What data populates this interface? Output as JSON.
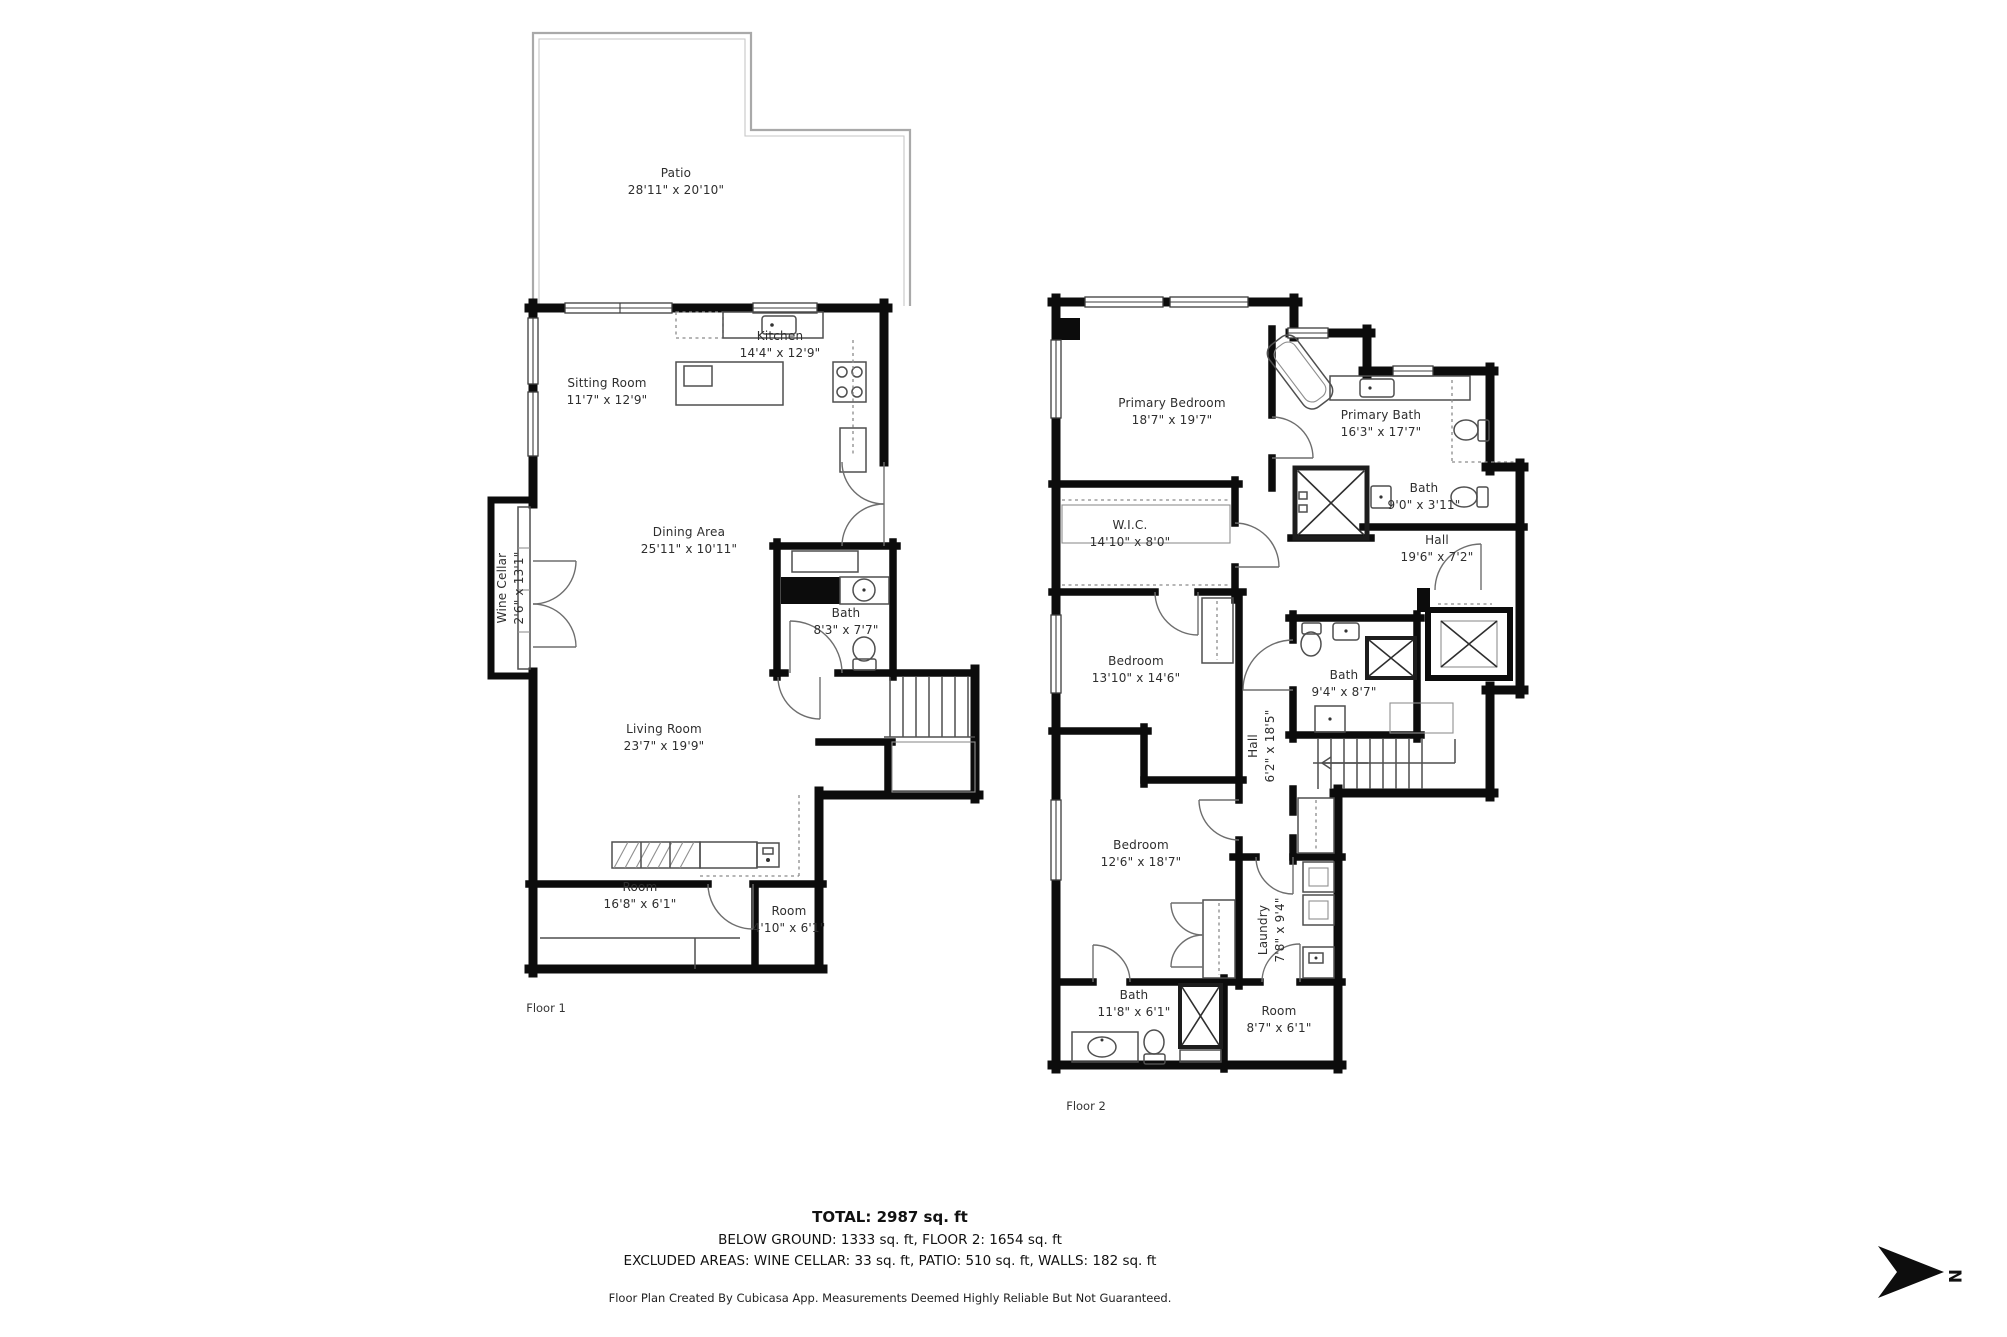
{
  "colors": {
    "wall": "#0c0c0c",
    "background": "#ffffff"
  },
  "floors": [
    {
      "caption": "Floor 1",
      "caption_pos": {
        "x": 546,
        "y": 1008
      },
      "rooms": [
        {
          "name": "Patio",
          "dims": "28'11\" x 20'10\"",
          "x": 676,
          "y": 182,
          "rotate": false
        },
        {
          "name": "Kitchen",
          "dims": "14'4\" x 12'9\"",
          "x": 780,
          "y": 345,
          "rotate": false
        },
        {
          "name": "Sitting Room",
          "dims": "11'7\" x 12'9\"",
          "x": 607,
          "y": 392,
          "rotate": false
        },
        {
          "name": "Dining Area",
          "dims": "25'11\" x 10'11\"",
          "x": 689,
          "y": 541,
          "rotate": false
        },
        {
          "name": "Wine Cellar",
          "dims": "2'6\" x 13'1\"",
          "x": 511,
          "y": 588,
          "rotate": true
        },
        {
          "name": "Bath",
          "dims": "8'3\" x 7'7\"",
          "x": 846,
          "y": 622,
          "rotate": false
        },
        {
          "name": "Living Room",
          "dims": "23'7\" x 19'9\"",
          "x": 664,
          "y": 738,
          "rotate": false
        },
        {
          "name": "Room",
          "dims": "16'8\" x 6'1\"",
          "x": 640,
          "y": 896,
          "rotate": false
        },
        {
          "name": "Room",
          "dims": "4'10\" x 6'1\"",
          "x": 789,
          "y": 920,
          "rotate": false
        }
      ]
    },
    {
      "caption": "Floor 2",
      "caption_pos": {
        "x": 1086,
        "y": 1106
      },
      "rooms": [
        {
          "name": "Primary Bedroom",
          "dims": "18'7\" x 19'7\"",
          "x": 1172,
          "y": 412,
          "rotate": false
        },
        {
          "name": "Primary Bath",
          "dims": "16'3\" x 17'7\"",
          "x": 1381,
          "y": 424,
          "rotate": false
        },
        {
          "name": "W.I.C.",
          "dims": "14'10\" x 8'0\"",
          "x": 1130,
          "y": 534,
          "rotate": false
        },
        {
          "name": "Bath",
          "dims": "9'0\" x 3'11\"",
          "x": 1424,
          "y": 497,
          "rotate": false
        },
        {
          "name": "Hall",
          "dims": "19'6\" x 7'2\"",
          "x": 1437,
          "y": 549,
          "rotate": false
        },
        {
          "name": "Bedroom",
          "dims": "13'10\" x 14'6\"",
          "x": 1136,
          "y": 670,
          "rotate": false
        },
        {
          "name": "Bath",
          "dims": "9'4\" x 8'7\"",
          "x": 1344,
          "y": 684,
          "rotate": false
        },
        {
          "name": "Hall",
          "dims": "6'2\" x 18'5\"",
          "x": 1262,
          "y": 746,
          "rotate": true
        },
        {
          "name": "Bedroom",
          "dims": "12'6\" x 18'7\"",
          "x": 1141,
          "y": 854,
          "rotate": false
        },
        {
          "name": "Laundry",
          "dims": "7'8\" x 9'4\"",
          "x": 1272,
          "y": 930,
          "rotate": true
        },
        {
          "name": "Bath",
          "dims": "11'8\" x 6'1\"",
          "x": 1134,
          "y": 1004,
          "rotate": false
        },
        {
          "name": "Room",
          "dims": "8'7\" x 6'1\"",
          "x": 1279,
          "y": 1020,
          "rotate": false
        }
      ]
    }
  ],
  "summary": {
    "total": "TOTAL: 2987 sq. ft",
    "line2": "BELOW GROUND: 1333 sq. ft, FLOOR 2: 1654 sq. ft",
    "line3": "EXCLUDED AREAS: WINE CELLAR: 33 sq. ft, PATIO: 510 sq. ft, WALLS: 182 sq. ft"
  },
  "footer": "Floor Plan Created By Cubicasa App. Measurements Deemed Highly Reliable But Not Guaranteed.",
  "compass": {
    "letter": "N"
  }
}
